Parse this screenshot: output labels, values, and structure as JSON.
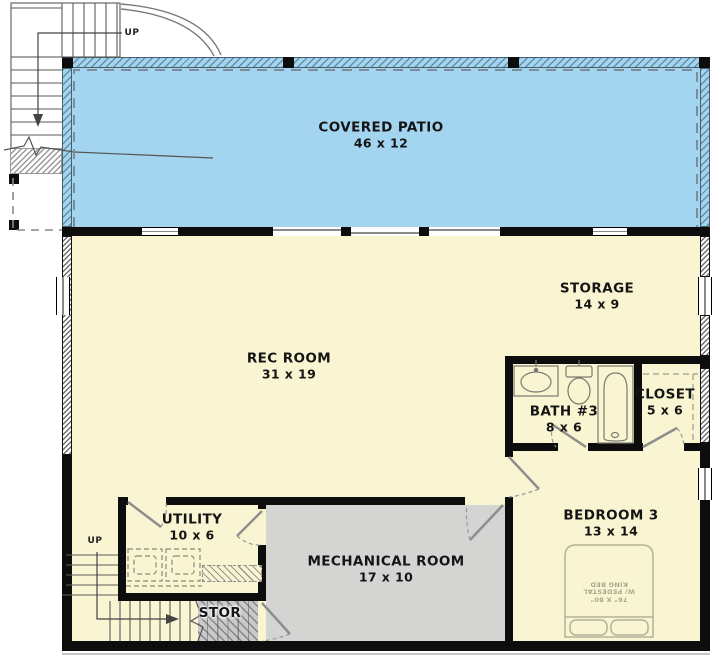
{
  "floorplan": {
    "rooms": {
      "patio": {
        "name": "COVERED PATIO",
        "dims": "46 x 12"
      },
      "rec": {
        "name": "REC ROOM",
        "dims": "31 x 19"
      },
      "storage": {
        "name": "STORAGE",
        "dims": "14 x 9"
      },
      "bath": {
        "name": "BATH #3",
        "dims": "8 x 6"
      },
      "closet": {
        "name": "CLOSET",
        "dims": "5 x 6"
      },
      "bedroom": {
        "name": "BEDROOM 3",
        "dims": "13 x 14"
      },
      "utility": {
        "name": "UTILITY",
        "dims": "10 x 6"
      },
      "mechanical": {
        "name": "MECHANICAL ROOM",
        "dims": "17 x 10"
      },
      "stor": {
        "name": "STOR"
      }
    },
    "stairs": {
      "upper_label": "UP",
      "lower_label": "UP"
    },
    "bed": {
      "size": "76\" X 80\"",
      "note": "W/ PEDESTAL",
      "type": "KING BED"
    },
    "colors": {
      "patio": "#a3d5f0",
      "floor": "#f9f5d2",
      "mechanical": "#d4d4d2",
      "wall": "#0d0d0d"
    }
  }
}
